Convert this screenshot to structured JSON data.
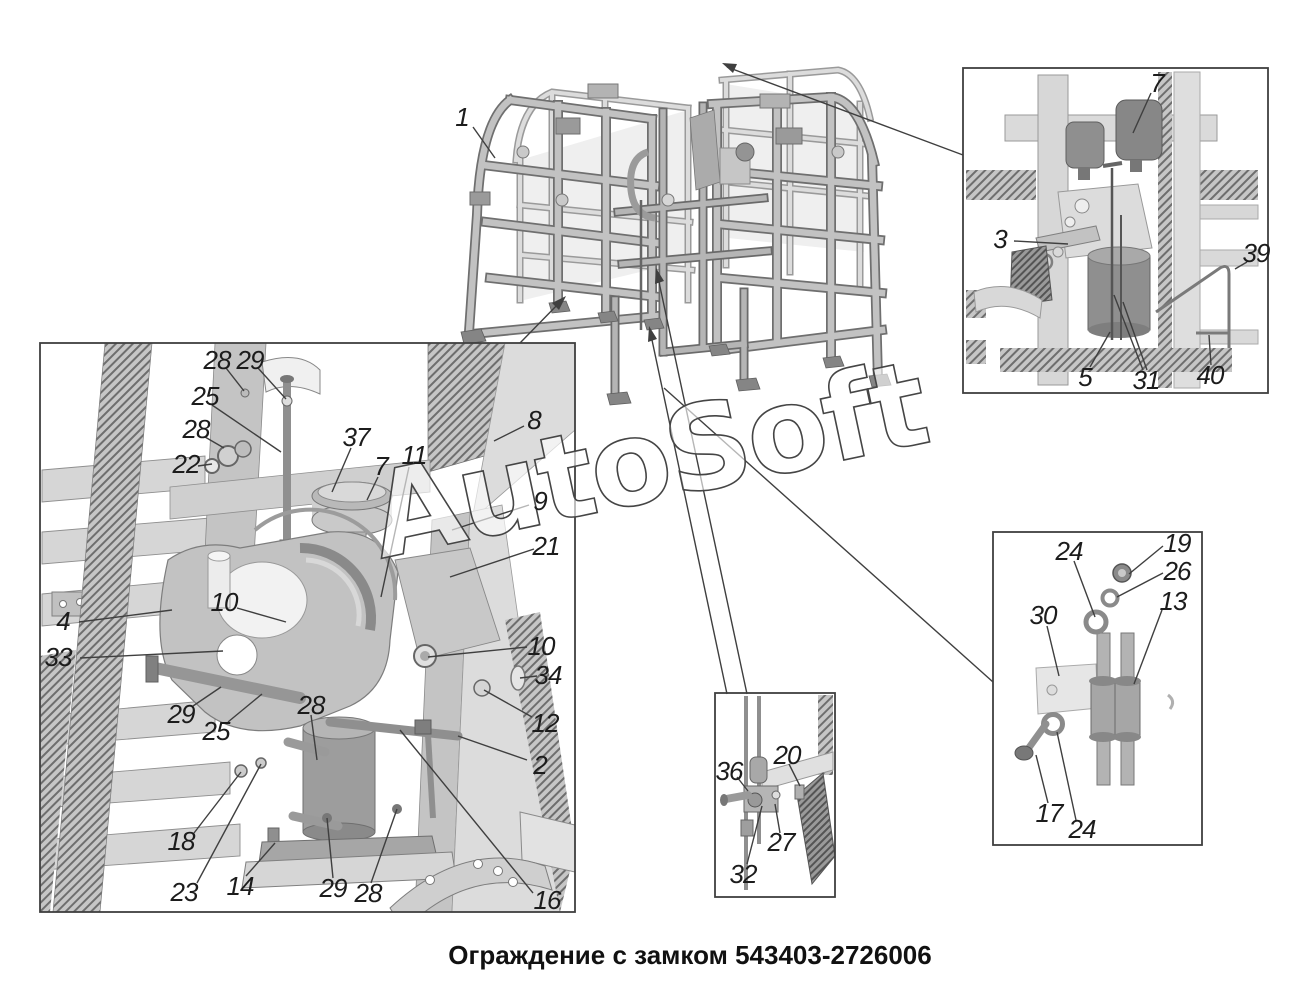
{
  "caption": "Ограждение с замком 543403-2726006",
  "watermark": "AutoSoft",
  "palette": {
    "line": "#3f3f3f",
    "beam_dark": "#6f6f6f",
    "beam_light": "#c2c2c2",
    "fill_light": "#d9d9d9",
    "fill_mid": "#9d9d9d",
    "background": "#ffffff"
  },
  "callouts": {
    "main": [
      "1"
    ],
    "big": [
      "28",
      "29",
      "25",
      "28",
      "22",
      "37",
      "7",
      "11",
      "8",
      "9",
      "21",
      "10",
      "4",
      "33",
      "29",
      "25",
      "28",
      "10",
      "34",
      "12",
      "2",
      "18",
      "23",
      "14",
      "29",
      "28",
      "16"
    ],
    "top_right": [
      "7",
      "3",
      "39",
      "5",
      "31",
      "40"
    ],
    "bottom_center": [
      "36",
      "20",
      "27",
      "32"
    ],
    "bottom_right": [
      "24",
      "19",
      "26",
      "13",
      "30",
      "17",
      "24"
    ]
  }
}
